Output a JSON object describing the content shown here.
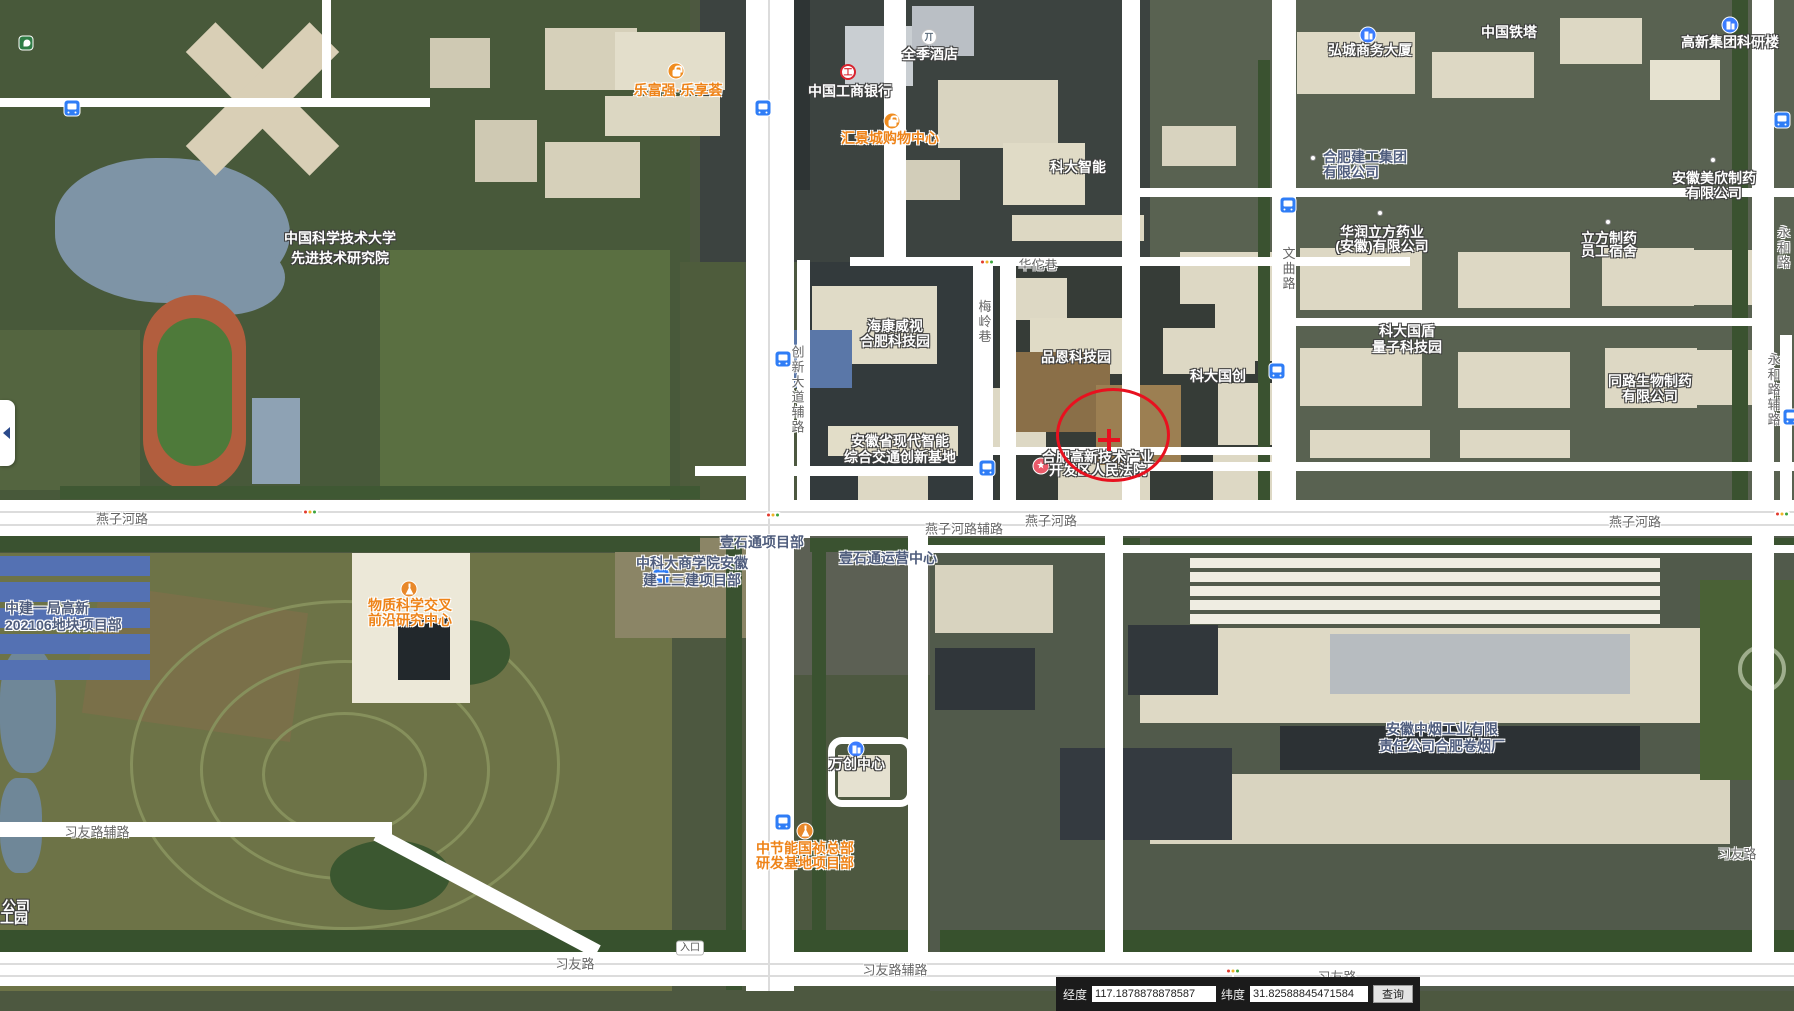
{
  "app": {
    "type": "satellite-map-viewer",
    "city_area": "合肥高新区"
  },
  "marker": {
    "shape": "circle-cross",
    "color": "#e8111f",
    "x": 1110,
    "y": 432,
    "rx": 54,
    "ry": 44,
    "cross_x": 1109,
    "cross_y": 440
  },
  "entrance_badge": {
    "text": "入口",
    "x": 690,
    "y": 948
  },
  "side_toggle": {
    "icon": "collapse-left-arrow"
  },
  "coordinate_bar": {
    "lng_label": "经度",
    "lng_value": "117.1878878878587",
    "lat_label": "纬度",
    "lat_value": "31.82588845471584",
    "search_label": "查询"
  },
  "poi_labels": [
    {
      "lines": [
        "中国科学技术大学",
        "先进技术研究院"
      ],
      "x": 340,
      "y": 238,
      "style": "white",
      "lh": 20
    },
    {
      "lines": [
        "乐富强·乐享荟"
      ],
      "x": 678,
      "y": 90,
      "style": "orange"
    },
    {
      "lines": [
        "中国工商银行"
      ],
      "x": 850,
      "y": 91,
      "style": "white"
    },
    {
      "lines": [
        "全季酒店"
      ],
      "x": 930,
      "y": 54,
      "style": "white"
    },
    {
      "lines": [
        "汇景城购物中心"
      ],
      "x": 890,
      "y": 138,
      "style": "orange"
    },
    {
      "lines": [
        "科大智能"
      ],
      "x": 1078,
      "y": 167,
      "style": "white"
    },
    {
      "lines": [
        "弘城商务大厦"
      ],
      "x": 1370,
      "y": 50,
      "style": "white"
    },
    {
      "lines": [
        "中国铁塔"
      ],
      "x": 1509,
      "y": 32,
      "style": "white"
    },
    {
      "lines": [
        "高新集团科研楼"
      ],
      "x": 1730,
      "y": 42,
      "style": "white"
    },
    {
      "lines": [
        "合肥建工集团",
        "有限公司"
      ],
      "x": 1323,
      "y": 157,
      "style": "slate",
      "lh": 15,
      "align": "left"
    },
    {
      "lines": [
        "华润立方药业",
        "(安徽)有限公司"
      ],
      "x": 1382,
      "y": 232,
      "style": "white",
      "lh": 14
    },
    {
      "lines": [
        "立方制药",
        "员工宿舍"
      ],
      "x": 1609,
      "y": 238,
      "style": "white",
      "lh": 13
    },
    {
      "lines": [
        "安徽美欣制药",
        "有限公司"
      ],
      "x": 1714,
      "y": 178,
      "style": "white",
      "lh": 15
    },
    {
      "lines": [
        "海康威视",
        "合肥科技园"
      ],
      "x": 895,
      "y": 326,
      "style": "white",
      "lh": 15
    },
    {
      "lines": [
        "品恩科技园"
      ],
      "x": 1076,
      "y": 357,
      "style": "white"
    },
    {
      "lines": [
        "科大国创"
      ],
      "x": 1218,
      "y": 376,
      "style": "white"
    },
    {
      "lines": [
        "科大国盾",
        "量子科技园"
      ],
      "x": 1407,
      "y": 331,
      "style": "white",
      "lh": 16
    },
    {
      "lines": [
        "同路生物制药",
        "有限公司"
      ],
      "x": 1650,
      "y": 381,
      "style": "white",
      "lh": 15
    },
    {
      "lines": [
        "安徽省现代智能",
        "综合交通创新基地"
      ],
      "x": 900,
      "y": 441,
      "style": "white",
      "lh": 16
    },
    {
      "lines": [
        "合肥高新技术产业",
        "开发区人民法院"
      ],
      "x": 1098,
      "y": 457,
      "style": "white",
      "lh": 13
    },
    {
      "lines": [
        "万创中心"
      ],
      "x": 857,
      "y": 764,
      "style": "white"
    },
    {
      "lines": [
        "中建一局高新",
        "202106地块项目部"
      ],
      "x": 5,
      "y": 608,
      "style": "slate",
      "lh": 17,
      "align": "left"
    },
    {
      "lines": [
        "物质科学交叉",
        "前沿研究中心"
      ],
      "x": 410,
      "y": 605,
      "style": "orange",
      "lh": 15
    },
    {
      "lines": [
        "中科大商学院安徽",
        "建工三建项目部"
      ],
      "x": 692,
      "y": 563,
      "style": "slate",
      "lh": 17
    },
    {
      "lines": [
        "壹石通项目部"
      ],
      "x": 762,
      "y": 542,
      "style": "slate"
    },
    {
      "lines": [
        "壹石通运营中心"
      ],
      "x": 888,
      "y": 558,
      "style": "slate"
    },
    {
      "lines": [
        "中节能国祯总部",
        "研发基地项目部"
      ],
      "x": 805,
      "y": 848,
      "style": "orange",
      "lh": 15
    },
    {
      "lines": [
        "安徽中烟工业有限",
        "责任公司合肥卷烟厂"
      ],
      "x": 1442,
      "y": 729,
      "style": "slate",
      "lh": 17
    },
    {
      "lines": [
        "公司"
      ],
      "x": 16,
      "y": 906,
      "style": "white"
    },
    {
      "lines": [
        "工园"
      ],
      "x": 14,
      "y": 918,
      "style": "white"
    }
  ],
  "road_labels": [
    {
      "lines": [
        "燕子河路"
      ],
      "x": 122,
      "y": 518,
      "style": "road"
    },
    {
      "lines": [
        "燕子河路"
      ],
      "x": 1051,
      "y": 520,
      "style": "road"
    },
    {
      "lines": [
        "燕子河路辅路"
      ],
      "x": 964,
      "y": 528,
      "style": "road"
    },
    {
      "lines": [
        "燕子河路"
      ],
      "x": 1635,
      "y": 521,
      "style": "road"
    },
    {
      "lines": [
        "华佗巷"
      ],
      "x": 1038,
      "y": 264,
      "style": "road"
    },
    {
      "lines": [
        "习友路辅路"
      ],
      "x": 97,
      "y": 831,
      "style": "road"
    },
    {
      "lines": [
        "习友路"
      ],
      "x": 575,
      "y": 963,
      "style": "road"
    },
    {
      "lines": [
        "习友路辅路"
      ],
      "x": 895,
      "y": 969,
      "style": "road"
    },
    {
      "lines": [
        "习友路"
      ],
      "x": 1337,
      "y": 976,
      "style": "road"
    },
    {
      "lines": [
        "习友路"
      ],
      "x": 1737,
      "y": 853,
      "style": "road"
    },
    {
      "lines": [
        "创新大道辅路"
      ],
      "x": 797,
      "y": 390,
      "style": "road-v"
    },
    {
      "lines": [
        "梅岭巷"
      ],
      "x": 984,
      "y": 322,
      "style": "road-v"
    },
    {
      "lines": [
        "文曲路"
      ],
      "x": 1288,
      "y": 269,
      "style": "road-v"
    },
    {
      "lines": [
        "永和路"
      ],
      "x": 1783,
      "y": 248,
      "style": "road-v"
    },
    {
      "lines": [
        "永和路辅路"
      ],
      "x": 1773,
      "y": 390,
      "style": "road-v"
    }
  ],
  "icons": [
    {
      "kind": "bus",
      "name": "bus-stop-icon",
      "x": 72,
      "y": 108
    },
    {
      "kind": "bus",
      "name": "bus-stop-icon",
      "x": 763,
      "y": 108
    },
    {
      "kind": "bus",
      "name": "bus-stop-icon",
      "x": 1288,
      "y": 205
    },
    {
      "kind": "bus",
      "name": "bus-stop-icon",
      "x": 1782,
      "y": 120
    },
    {
      "kind": "bus",
      "name": "bus-stop-icon",
      "x": 783,
      "y": 359
    },
    {
      "kind": "bus",
      "name": "bus-stop-icon",
      "x": 987,
      "y": 468
    },
    {
      "kind": "bus",
      "name": "bus-stop-icon",
      "x": 1277,
      "y": 371
    },
    {
      "kind": "bus",
      "name": "bus-stop-icon",
      "x": 661,
      "y": 577
    },
    {
      "kind": "bus",
      "name": "bus-stop-icon",
      "x": 783,
      "y": 822
    },
    {
      "kind": "bus",
      "name": "bus-stop-icon",
      "x": 1791,
      "y": 417
    },
    {
      "kind": "traffic",
      "name": "traffic-light-icon",
      "x": 987,
      "y": 262
    },
    {
      "kind": "traffic",
      "name": "traffic-light-icon",
      "x": 310,
      "y": 512
    },
    {
      "kind": "traffic",
      "name": "traffic-light-icon",
      "x": 773,
      "y": 515
    },
    {
      "kind": "traffic",
      "name": "traffic-light-icon",
      "x": 1782,
      "y": 514
    },
    {
      "kind": "traffic",
      "name": "traffic-light-icon",
      "x": 1233,
      "y": 971
    },
    {
      "kind": "bag",
      "name": "shopping-icon",
      "x": 676,
      "y": 71
    },
    {
      "kind": "bag",
      "name": "shopping-icon",
      "x": 892,
      "y": 121
    },
    {
      "kind": "bldg",
      "name": "office-building-icon",
      "x": 1368,
      "y": 35
    },
    {
      "kind": "bldg",
      "name": "office-building-icon",
      "x": 1730,
      "y": 25
    },
    {
      "kind": "bldg",
      "name": "office-building-icon",
      "x": 856,
      "y": 749
    },
    {
      "kind": "flask",
      "name": "research-flask-icon",
      "x": 409,
      "y": 589
    },
    {
      "kind": "flask",
      "name": "research-flask-icon",
      "x": 805,
      "y": 831
    },
    {
      "kind": "star",
      "name": "government-star-icon",
      "x": 1041,
      "y": 466
    },
    {
      "kind": "icbc",
      "name": "icbc-bank-icon",
      "x": 848,
      "y": 72
    },
    {
      "kind": "hotel",
      "name": "hotel-icon",
      "x": 929,
      "y": 37
    },
    {
      "kind": "green",
      "name": "park-icon",
      "x": 26,
      "y": 43
    },
    {
      "kind": "dot",
      "name": "poi-dot",
      "x": 1313,
      "y": 158
    },
    {
      "kind": "dot",
      "name": "poi-dot",
      "x": 1380,
      "y": 213
    },
    {
      "kind": "dot",
      "name": "poi-dot",
      "x": 1608,
      "y": 222
    },
    {
      "kind": "dot",
      "name": "poi-dot",
      "x": 1713,
      "y": 160
    }
  ]
}
